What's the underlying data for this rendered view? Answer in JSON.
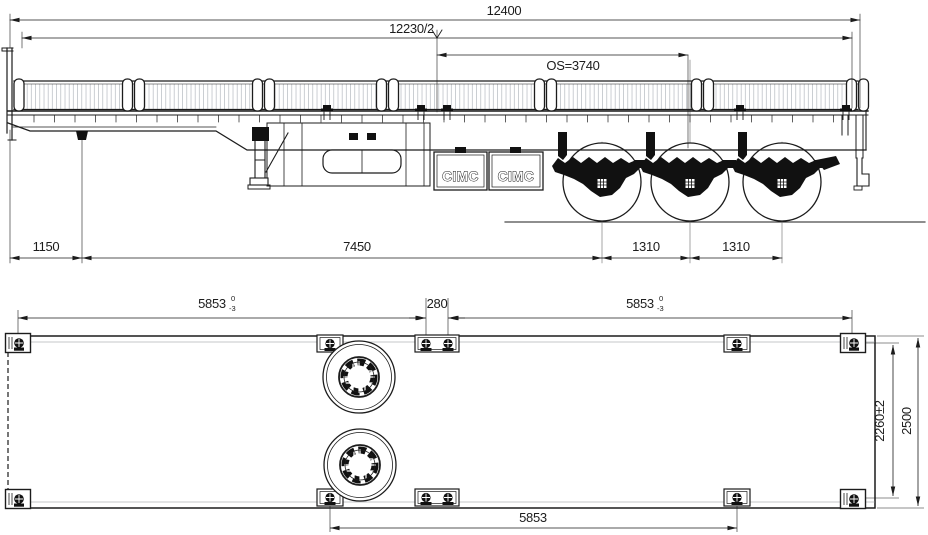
{
  "side_view": {
    "brand_panels": [
      "CIMC",
      "CIMC"
    ],
    "dims": {
      "overall_length": "12400",
      "half_ref": "12230/2",
      "os_span": "OS=3740",
      "front_overhang": "1150",
      "kingpin_to_first_axle": "7450",
      "axle_spacing_1": "1310",
      "axle_spacing_2": "1310"
    }
  },
  "plan_view": {
    "dims": {
      "front_lock_span": "5853",
      "front_lock_tol_upper": "0",
      "front_lock_tol_lower": "-3",
      "center_gap": "280",
      "rear_lock_span": "5853",
      "rear_lock_tol_upper": "0",
      "rear_lock_tol_lower": "-3",
      "bottom_lock_span": "5853",
      "lock_row_width": "2260±2",
      "overall_width": "2500"
    }
  },
  "colors": {
    "line": "#1c1c1c",
    "hatch": "#a8adb3",
    "background": "#ffffff"
  }
}
